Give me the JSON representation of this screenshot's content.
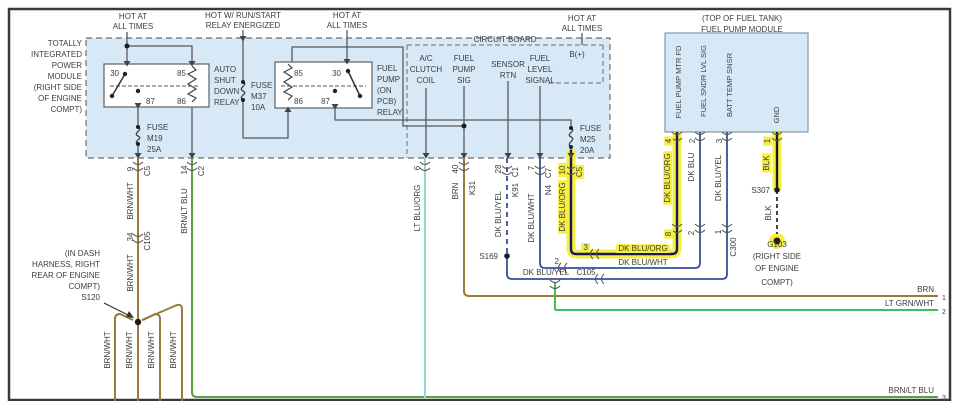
{
  "title": "Fuel Pump Module Wiring Diagram",
  "colors": {
    "background": "#ffffff",
    "border": "#3a3a3a",
    "module_fill": "#d7e8f7",
    "text": "#3d3d3d",
    "highlight": "#f7ef3e",
    "wire_brn": "#9a7a3a",
    "wire_brn_lt_blu": "#56a23c",
    "wire_lt_grn_wht": "#3fbf55",
    "wire_lt_blu_org": "#93d8cf",
    "wire_dk_blu": "#35509d",
    "wire_dk_blu_org": "#171763",
    "wire_blk": "#1a1a1a",
    "wire_gray": "#5a5a5a"
  },
  "labels": [
    {
      "n": "hot-at-1a",
      "t": "HOT AT",
      "x": 133,
      "y": 19,
      "r": 0,
      "a": "m"
    },
    {
      "n": "hot-at-1b",
      "t": "ALL TIMES",
      "x": 133,
      "y": 29,
      "r": 0,
      "a": "m"
    },
    {
      "n": "hot-run-start-a",
      "t": "HOT W/ RUN/START",
      "x": 243,
      "y": 18,
      "r": 0,
      "a": "m"
    },
    {
      "n": "hot-run-start-b",
      "t": "RELAY ENERGIZED",
      "x": 243,
      "y": 28,
      "r": 0,
      "a": "m"
    },
    {
      "n": "hot-at-2a",
      "t": "HOT AT",
      "x": 347,
      "y": 18,
      "r": 0,
      "a": "m"
    },
    {
      "n": "hot-at-2b",
      "t": "ALL TIMES",
      "x": 347,
      "y": 28,
      "r": 0,
      "a": "m"
    },
    {
      "n": "hot-at-3a",
      "t": "HOT AT",
      "x": 582,
      "y": 21,
      "r": 0,
      "a": "m"
    },
    {
      "n": "hot-at-3b",
      "t": "ALL TIMES",
      "x": 582,
      "y": 31,
      "r": 0,
      "a": "m"
    },
    {
      "n": "fuel-pump-module-caption-a",
      "t": "(TOP OF FUEL TANK)",
      "x": 742,
      "y": 21,
      "r": 0,
      "a": "m"
    },
    {
      "n": "fuel-pump-module-caption-b",
      "t": "FUEL PUMP MODULE",
      "x": 742,
      "y": 32,
      "r": 0,
      "a": "m"
    },
    {
      "n": "tipm-caption-1",
      "t": "TOTALLY",
      "x": 82,
      "y": 46,
      "r": 0,
      "a": "e"
    },
    {
      "n": "tipm-caption-2",
      "t": "INTEGRATED",
      "x": 82,
      "y": 57,
      "r": 0,
      "a": "e"
    },
    {
      "n": "tipm-caption-3",
      "t": "POWER",
      "x": 82,
      "y": 68,
      "r": 0,
      "a": "e"
    },
    {
      "n": "tipm-caption-4",
      "t": "MODULE",
      "x": 82,
      "y": 79,
      "r": 0,
      "a": "e"
    },
    {
      "n": "tipm-caption-5",
      "t": "(RIGHT SIDE",
      "x": 82,
      "y": 90,
      "r": 0,
      "a": "e"
    },
    {
      "n": "tipm-caption-6",
      "t": "OF ENGINE",
      "x": 82,
      "y": 101,
      "r": 0,
      "a": "e"
    },
    {
      "n": "tipm-caption-7",
      "t": "COMPT)",
      "x": 82,
      "y": 112,
      "r": 0,
      "a": "e"
    },
    {
      "n": "circuit-board-caption",
      "t": "CIRCUIT BOARD",
      "x": 505,
      "y": 42,
      "r": 0,
      "a": "m"
    },
    {
      "n": "asd-pin-30",
      "t": "30",
      "x": 119,
      "y": 76,
      "r": 0,
      "a": "e"
    },
    {
      "n": "asd-pin-85",
      "t": "85",
      "x": 186,
      "y": 76,
      "r": 0,
      "a": "e"
    },
    {
      "n": "asd-pin-87",
      "t": "87",
      "x": 146,
      "y": 104,
      "r": 0,
      "a": "s"
    },
    {
      "n": "asd-pin-86",
      "t": "86",
      "x": 186,
      "y": 104,
      "r": 0,
      "a": "e"
    },
    {
      "n": "asd-relay-caption-1",
      "t": "AUTO",
      "x": 214,
      "y": 72,
      "r": 0,
      "a": "s"
    },
    {
      "n": "asd-relay-caption-2",
      "t": "SHUT",
      "x": 214,
      "y": 83,
      "r": 0,
      "a": "s"
    },
    {
      "n": "asd-relay-caption-3",
      "t": "DOWN",
      "x": 214,
      "y": 94,
      "r": 0,
      "a": "s"
    },
    {
      "n": "asd-relay-caption-4",
      "t": "RELAY",
      "x": 214,
      "y": 105,
      "r": 0,
      "a": "s"
    },
    {
      "n": "fuse-m19-1",
      "t": "FUSE",
      "x": 147,
      "y": 130,
      "r": 0,
      "a": "s"
    },
    {
      "n": "fuse-m19-2",
      "t": "M19",
      "x": 147,
      "y": 141,
      "r": 0,
      "a": "s"
    },
    {
      "n": "fuse-m19-3",
      "t": "25A",
      "x": 147,
      "y": 152,
      "r": 0,
      "a": "s"
    },
    {
      "n": "fp-relay-pin-85",
      "t": "85",
      "x": 294,
      "y": 76,
      "r": 0,
      "a": "s"
    },
    {
      "n": "fp-relay-pin-30",
      "t": "30",
      "x": 341,
      "y": 76,
      "r": 0,
      "a": "e"
    },
    {
      "n": "fp-relay-pin-86",
      "t": "86",
      "x": 294,
      "y": 104,
      "r": 0,
      "a": "s"
    },
    {
      "n": "fp-relay-pin-87",
      "t": "87",
      "x": 330,
      "y": 104,
      "r": 0,
      "a": "e"
    },
    {
      "n": "fp-relay-caption-1",
      "t": "FUEL",
      "x": 377,
      "y": 71,
      "r": 0,
      "a": "s"
    },
    {
      "n": "fp-relay-caption-2",
      "t": "PUMP",
      "x": 377,
      "y": 82,
      "r": 0,
      "a": "s"
    },
    {
      "n": "fp-relay-caption-3",
      "t": "(ON",
      "x": 377,
      "y": 93,
      "r": 0,
      "a": "s"
    },
    {
      "n": "fp-relay-caption-4",
      "t": "PCB)",
      "x": 377,
      "y": 104,
      "r": 0,
      "a": "s"
    },
    {
      "n": "fp-relay-caption-5",
      "t": "RELAY",
      "x": 377,
      "y": 115,
      "r": 0,
      "a": "s"
    },
    {
      "n": "fuse-m37-1",
      "t": "FUSE",
      "x": 251,
      "y": 88,
      "r": 0,
      "a": "s"
    },
    {
      "n": "fuse-m37-2",
      "t": "M37",
      "x": 251,
      "y": 99,
      "r": 0,
      "a": "s"
    },
    {
      "n": "fuse-m37-3",
      "t": "10A",
      "x": 251,
      "y": 110,
      "r": 0,
      "a": "s"
    },
    {
      "n": "fuse-m25-1",
      "t": "FUSE",
      "x": 580,
      "y": 131,
      "r": 0,
      "a": "s"
    },
    {
      "n": "fuse-m25-2",
      "t": "M25",
      "x": 580,
      "y": 142,
      "r": 0,
      "a": "s"
    },
    {
      "n": "fuse-m25-3",
      "t": "20A",
      "x": 580,
      "y": 153,
      "r": 0,
      "a": "s"
    },
    {
      "n": "cb-ac-clutch-1",
      "t": "A/C",
      "x": 426,
      "y": 61,
      "r": 0,
      "a": "m"
    },
    {
      "n": "cb-ac-clutch-2",
      "t": "CLUTCH",
      "x": 426,
      "y": 72,
      "r": 0,
      "a": "m"
    },
    {
      "n": "cb-ac-clutch-3",
      "t": "COIL",
      "x": 426,
      "y": 83,
      "r": 0,
      "a": "m"
    },
    {
      "n": "cb-fuel-pump-sig-1",
      "t": "FUEL",
      "x": 464,
      "y": 61,
      "r": 0,
      "a": "m"
    },
    {
      "n": "cb-fuel-pump-sig-2",
      "t": "PUMP",
      "x": 464,
      "y": 72,
      "r": 0,
      "a": "m"
    },
    {
      "n": "cb-fuel-pump-sig-3",
      "t": "SIG",
      "x": 464,
      "y": 83,
      "r": 0,
      "a": "m"
    },
    {
      "n": "cb-sensor-rtn-1",
      "t": "SENSOR",
      "x": 508,
      "y": 67,
      "r": 0,
      "a": "m"
    },
    {
      "n": "cb-sensor-rtn-2",
      "t": "RTN",
      "x": 508,
      "y": 78,
      "r": 0,
      "a": "m"
    },
    {
      "n": "cb-fuel-level-1",
      "t": "FUEL",
      "x": 540,
      "y": 61,
      "r": 0,
      "a": "m"
    },
    {
      "n": "cb-fuel-level-2",
      "t": "LEVEL",
      "x": 540,
      "y": 72,
      "r": 0,
      "a": "m"
    },
    {
      "n": "cb-fuel-level-3",
      "t": "SIGNAL",
      "x": 540,
      "y": 83,
      "r": 0,
      "a": "m"
    },
    {
      "n": "cb-b-plus",
      "t": "B(+)",
      "x": 577,
      "y": 57,
      "r": 0,
      "a": "m"
    },
    {
      "n": "s120-caption-1",
      "t": "(IN DASH",
      "x": 100,
      "y": 256,
      "r": 0,
      "a": "e"
    },
    {
      "n": "s120-caption-2",
      "t": "HARNESS, RIGHT",
      "x": 100,
      "y": 267,
      "r": 0,
      "a": "e"
    },
    {
      "n": "s120-caption-3",
      "t": "REAR OF ENGINE",
      "x": 100,
      "y": 278,
      "r": 0,
      "a": "e"
    },
    {
      "n": "s120-caption-4",
      "t": "COMPT)",
      "x": 100,
      "y": 289,
      "r": 0,
      "a": "e"
    },
    {
      "n": "s120-label",
      "t": "S120",
      "x": 100,
      "y": 300,
      "r": 0,
      "a": "e"
    },
    {
      "n": "s169-label",
      "t": "S169",
      "x": 498,
      "y": 259,
      "r": 0,
      "a": "e"
    },
    {
      "n": "s307-label",
      "t": "S307",
      "x": 770,
      "y": 193,
      "r": 0,
      "a": "e"
    },
    {
      "n": "g103-label",
      "t": "G103",
      "x": 777,
      "y": 247,
      "r": 0,
      "a": "m"
    },
    {
      "n": "g103-caption-1",
      "t": "(RIGHT SIDE",
      "x": 777,
      "y": 259,
      "r": 0,
      "a": "m"
    },
    {
      "n": "g103-caption-2",
      "t": "OF ENGINE",
      "x": 777,
      "y": 271,
      "r": 0,
      "a": "m"
    },
    {
      "n": "g103-caption-3",
      "t": "COMPT)",
      "x": 777,
      "y": 285,
      "r": 0,
      "a": "m"
    },
    {
      "n": "wire-dk-blu-yel-h",
      "t": "DK BLU/YEL",
      "x": 546,
      "y": 275,
      "r": 0,
      "a": "m"
    },
    {
      "n": "conn-c105-h",
      "t": "C105",
      "x": 586,
      "y": 275,
      "r": 0,
      "a": "m"
    },
    {
      "n": "wire-dk-blu-org-h",
      "t": "DK BLU/ORG",
      "x": 643,
      "y": 251,
      "r": 0,
      "a": "m",
      "hl": true
    },
    {
      "n": "wire-dk-blu-wht-h",
      "t": "DK BLU/WHT",
      "x": 643,
      "y": 265,
      "r": 0,
      "a": "m"
    },
    {
      "n": "c105-pin-3",
      "t": "3",
      "x": 588,
      "y": 250,
      "r": 0,
      "a": "e",
      "hl": true
    },
    {
      "n": "c105-pin-2",
      "t": "2",
      "x": 559,
      "y": 264,
      "r": 0,
      "a": "e"
    },
    {
      "n": "wire-brn-right",
      "t": "BRN",
      "x": 934,
      "y": 292,
      "r": 0,
      "a": "e"
    },
    {
      "n": "pin-right-1",
      "t": "1",
      "x": 942,
      "y": 300,
      "r": 0,
      "a": "s",
      "s": 7
    },
    {
      "n": "wire-lt-grn-wht-right",
      "t": "LT GRN/WHT",
      "x": 934,
      "y": 306,
      "r": 0,
      "a": "e"
    },
    {
      "n": "pin-right-2",
      "t": "2",
      "x": 942,
      "y": 314,
      "r": 0,
      "a": "s",
      "s": 7
    },
    {
      "n": "wire-brn-lt-blu-right",
      "t": "BRN/LT BLU",
      "x": 934,
      "y": 393,
      "r": 0,
      "a": "e"
    },
    {
      "n": "pin-right-3",
      "t": "3",
      "x": 942,
      "y": 400,
      "r": 0,
      "a": "s",
      "s": 7
    },
    {
      "n": "pin-9",
      "t": "9",
      "x": 133,
      "y": 169,
      "r": -90,
      "a": "m"
    },
    {
      "n": "conn-c5-asd",
      "t": "C5",
      "x": 150,
      "y": 171,
      "r": -90,
      "a": "m"
    },
    {
      "n": "wire-brn-wht-1",
      "t": "BRN/WHT",
      "x": 133,
      "y": 201,
      "r": -90,
      "a": "m"
    },
    {
      "n": "pin-34",
      "t": "34",
      "x": 133,
      "y": 237,
      "r": -90,
      "a": "m"
    },
    {
      "n": "conn-c105-v",
      "t": "C105",
      "x": 150,
      "y": 241,
      "r": -90,
      "a": "m"
    },
    {
      "n": "wire-brn-wht-2",
      "t": "BRN/WHT",
      "x": 133,
      "y": 273,
      "r": -90,
      "a": "m"
    },
    {
      "n": "pin-14",
      "t": "14",
      "x": 187,
      "y": 170,
      "r": -90,
      "a": "m"
    },
    {
      "n": "conn-c2",
      "t": "C2",
      "x": 204,
      "y": 171,
      "r": -90,
      "a": "m"
    },
    {
      "n": "wire-brn-lt-blu-v",
      "t": "BRN/LT BLU",
      "x": 187,
      "y": 211,
      "r": -90,
      "a": "m"
    },
    {
      "n": "pin-6",
      "t": "6",
      "x": 420,
      "y": 168,
      "r": -90,
      "a": "m"
    },
    {
      "n": "wire-lt-blu-org-v",
      "t": "LT BLU/ORG",
      "x": 420,
      "y": 208,
      "r": -90,
      "a": "m"
    },
    {
      "n": "pin-40",
      "t": "40",
      "x": 458,
      "y": 169,
      "r": -90,
      "a": "m"
    },
    {
      "n": "conn-k31",
      "t": "K31",
      "x": 475,
      "y": 188,
      "r": -90,
      "a": "m"
    },
    {
      "n": "wire-brn-v",
      "t": "BRN",
      "x": 458,
      "y": 191,
      "r": -90,
      "a": "m"
    },
    {
      "n": "pin-28",
      "t": "28",
      "x": 501,
      "y": 169,
      "r": -90,
      "a": "m"
    },
    {
      "n": "conn-c1",
      "t": "C1",
      "x": 518,
      "y": 172,
      "r": -90,
      "a": "m"
    },
    {
      "n": "conn-k91",
      "t": "K91",
      "x": 518,
      "y": 190,
      "r": -90,
      "a": "m"
    },
    {
      "n": "wire-dk-blu-yel-v",
      "t": "DK BLU/YEL",
      "x": 501,
      "y": 214,
      "r": -90,
      "a": "m"
    },
    {
      "n": "pin-7",
      "t": "7",
      "x": 534,
      "y": 168,
      "r": -90,
      "a": "m"
    },
    {
      "n": "conn-c7",
      "t": "C7",
      "x": 551,
      "y": 173,
      "r": -90,
      "a": "m"
    },
    {
      "n": "conn-n4",
      "t": "N4",
      "x": 551,
      "y": 190,
      "r": -90,
      "a": "m"
    },
    {
      "n": "wire-dk-blu-wht-v",
      "t": "DK BLU/WHT",
      "x": 534,
      "y": 218,
      "r": -90,
      "a": "m"
    },
    {
      "n": "pin-10",
      "t": "10",
      "x": 565,
      "y": 170,
      "r": -90,
      "a": "m",
      "hl": true
    },
    {
      "n": "conn-c5-fp",
      "t": "C5",
      "x": 582,
      "y": 172,
      "r": -90,
      "a": "m",
      "hl": true
    },
    {
      "n": "wire-dk-blu-org-v1",
      "t": "DK BLU/ORG",
      "x": 565,
      "y": 207,
      "r": -90,
      "a": "m",
      "hl": true
    },
    {
      "n": "c300-pin-8",
      "t": "8",
      "x": 671,
      "y": 234,
      "r": -90,
      "a": "m",
      "hl": true
    },
    {
      "n": "c300-pin-2",
      "t": "2",
      "x": 694,
      "y": 233,
      "r": -90,
      "a": "m"
    },
    {
      "n": "c300-pin-1",
      "t": "1",
      "x": 721,
      "y": 232,
      "r": -90,
      "a": "m"
    },
    {
      "n": "conn-c300",
      "t": "C300",
      "x": 736,
      "y": 247,
      "r": -90,
      "a": "m"
    },
    {
      "n": "fpm-pin-4",
      "t": "4",
      "x": 671,
      "y": 141,
      "r": -90,
      "a": "m",
      "hl": true
    },
    {
      "n": "fpm-pin-2",
      "t": "2",
      "x": 695,
      "y": 141,
      "r": -90,
      "a": "m"
    },
    {
      "n": "fpm-pin-3",
      "t": "3",
      "x": 722,
      "y": 141,
      "r": -90,
      "a": "m"
    },
    {
      "n": "fpm-pin-1",
      "t": "1",
      "x": 770,
      "y": 141,
      "r": -90,
      "a": "m",
      "hl": true
    },
    {
      "n": "wire-dk-blu-org-v2",
      "t": "DK BLU/ORG",
      "x": 670,
      "y": 178,
      "r": -90,
      "a": "m",
      "hl": true
    },
    {
      "n": "wire-dk-blu-v",
      "t": "DK BLU",
      "x": 694,
      "y": 167,
      "r": -90,
      "a": "m"
    },
    {
      "n": "wire-dk-blu-yel-v2",
      "t": "DK BLU/YEL",
      "x": 721,
      "y": 178,
      "r": -90,
      "a": "m"
    },
    {
      "n": "wire-blk-1",
      "t": "BLK",
      "x": 769,
      "y": 163,
      "r": -90,
      "a": "m",
      "hl": true
    },
    {
      "n": "wire-blk-2",
      "t": "BLK",
      "x": 771,
      "y": 213,
      "r": -90,
      "a": "m"
    },
    {
      "n": "wire-brn-wht-s1",
      "t": "BRN/WHT",
      "x": 110,
      "y": 350,
      "r": -90,
      "a": "m"
    },
    {
      "n": "wire-brn-wht-s2",
      "t": "BRN/WHT",
      "x": 132,
      "y": 350,
      "r": -90,
      "a": "m"
    },
    {
      "n": "wire-brn-wht-s3",
      "t": "BRN/WHT",
      "x": 154,
      "y": 350,
      "r": -90,
      "a": "m"
    },
    {
      "n": "wire-brn-wht-s4",
      "t": "BRN/WHT",
      "x": 176,
      "y": 350,
      "r": -90,
      "a": "m"
    },
    {
      "n": "fpm-pin-name-1",
      "t": "FUEL PUMP MTR FD",
      "x": 681,
      "y": 82,
      "r": -90,
      "a": "m",
      "s": 7.5
    },
    {
      "n": "fpm-pin-name-2",
      "t": "FUEL SNDR LVL SIG",
      "x": 706,
      "y": 81,
      "r": -90,
      "a": "m",
      "s": 7.5
    },
    {
      "n": "fpm-pin-name-3",
      "t": "BATT TEMP SNSR",
      "x": 732,
      "y": 85,
      "r": -90,
      "a": "m",
      "s": 7.5
    },
    {
      "n": "fpm-pin-name-4",
      "t": "GND",
      "x": 779,
      "y": 115,
      "r": -90,
      "a": "m",
      "s": 7.5
    }
  ]
}
